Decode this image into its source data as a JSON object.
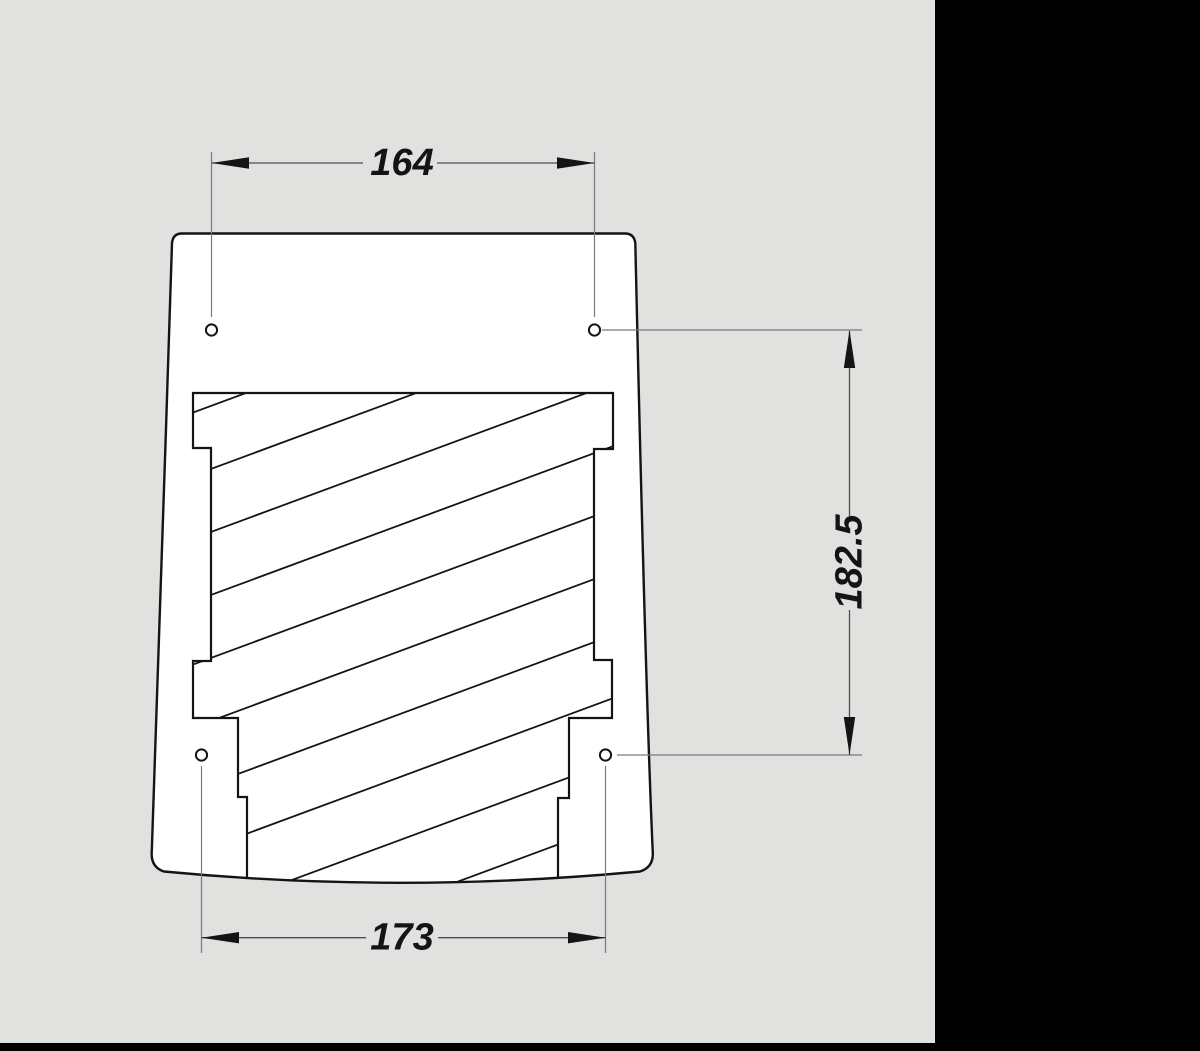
{
  "drawing": {
    "type": "technical-section-view",
    "dimension_labels": {
      "top": "164",
      "bottom": "173",
      "right": "182.5"
    },
    "hole_count": 4
  },
  "colors": {
    "background": "#e1e1e0",
    "panel": "#000000",
    "ink": "#141414",
    "part-fill": "#ffffff",
    "dim-line": "#4f4f4f",
    "ext-line": "#7a7a7a"
  }
}
